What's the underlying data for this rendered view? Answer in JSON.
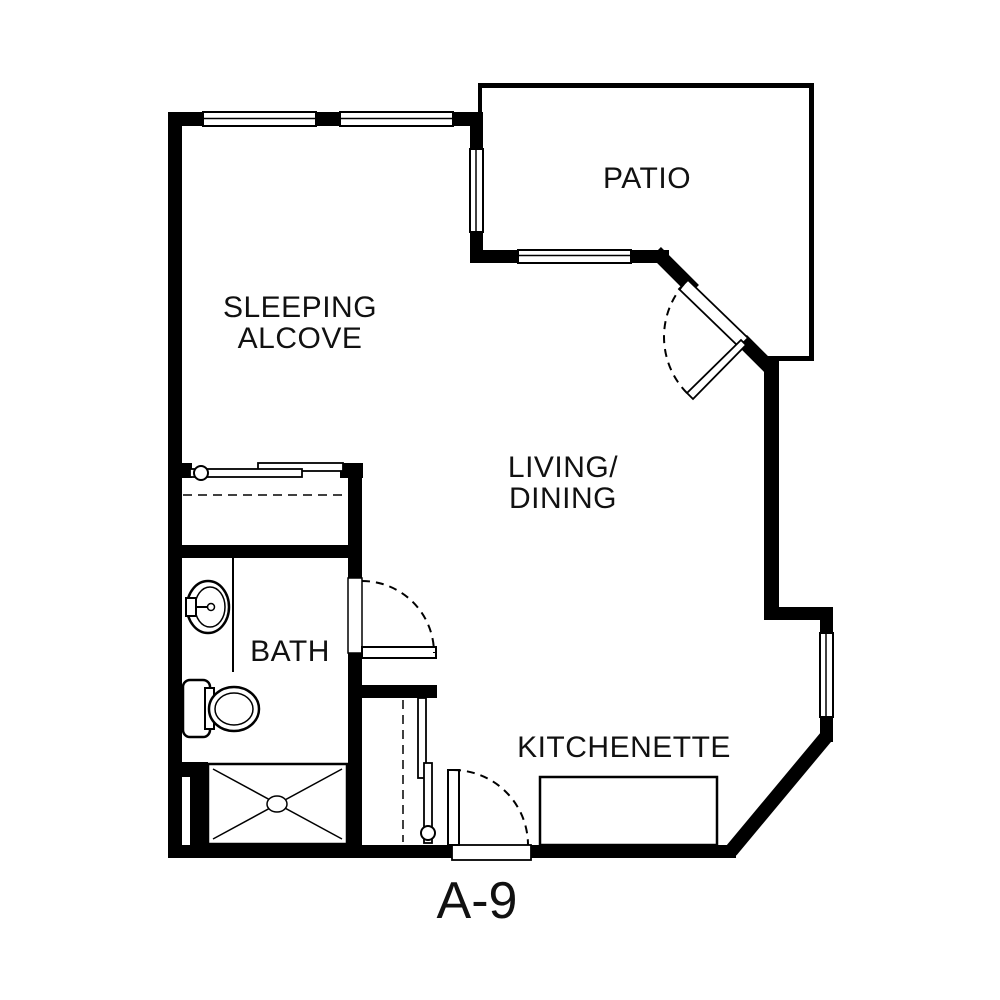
{
  "unit_label": "A-9",
  "rooms": {
    "sleeping_alcove": {
      "line1": "SLEEPING",
      "line2": "ALCOVE"
    },
    "living_dining": {
      "line1": "LIVING/",
      "line2": "DINING"
    },
    "patio": "PATIO",
    "bath": "BATH",
    "kitchenette": "KITCHENETTE"
  },
  "colors": {
    "wall": "#000000",
    "background": "#ffffff",
    "line": "#111111"
  }
}
